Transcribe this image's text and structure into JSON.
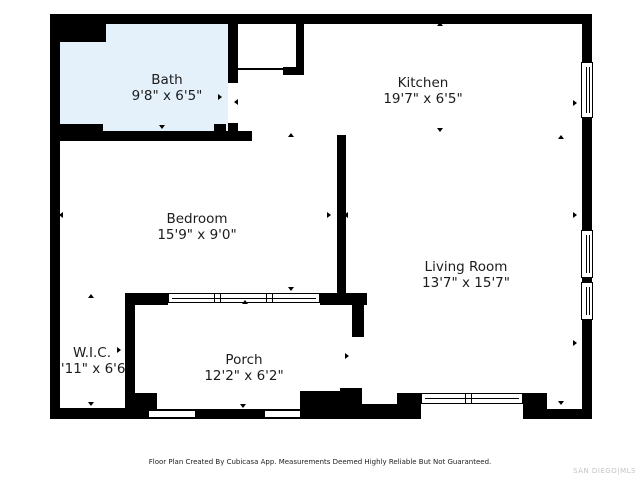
{
  "rooms": {
    "bath": {
      "name": "Bath",
      "dims": "9'8\" x 6'5\""
    },
    "kitchen": {
      "name": "Kitchen",
      "dims": "19'7\" x 6'5\""
    },
    "bedroom": {
      "name": "Bedroom",
      "dims": "15'9\" x 9'0\""
    },
    "living": {
      "name": "Living Room",
      "dims": "13'7\" x 15'7\""
    },
    "wic": {
      "name": "W.I.C.",
      "dims": "3'11\" x 6'6\""
    },
    "porch": {
      "name": "Porch",
      "dims": "12'2\" x 6'2\""
    }
  },
  "footer": {
    "disclaimer": "Floor Plan Created By Cubicasa App. Measurements Deemed Highly Reliable But Not Guaranteed.",
    "watermark": "SAN DIEGO|MLS"
  },
  "colors": {
    "wall": "#000000",
    "bath_fill": "#e4f1fb",
    "background": "#ffffff",
    "label_text": "#1c1c1c",
    "watermark_text": "#c4c4c4"
  }
}
